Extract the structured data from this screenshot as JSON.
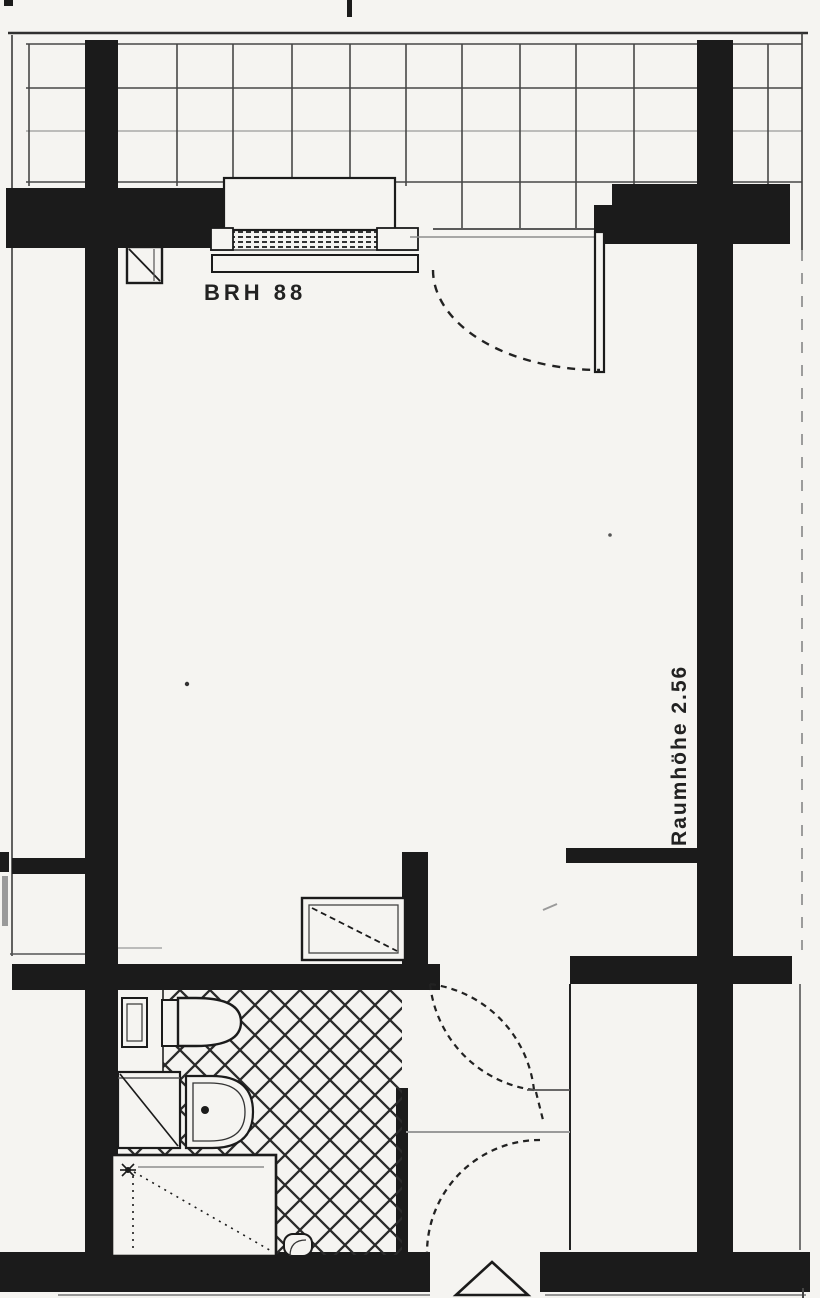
{
  "document": {
    "kind": "scanned apartment floor plan",
    "palette": {
      "paper": "#f5f4f1",
      "ink": "#1b1b1b",
      "faint_gray": "#8d8d8d"
    }
  },
  "annotations": {
    "parapet_height_label": "BRH 88",
    "room_height_label": "Raumhöhe 2.56"
  },
  "symbols": [
    "balcony-tile-grid",
    "window",
    "balcony-door-swing",
    "room-door-swing",
    "entrance-door-swing",
    "shaft-box",
    "cistern",
    "toilet",
    "shower-square",
    "washbasin",
    "bathtub",
    "floor-drain",
    "entrance-triangle-marker",
    "crosshatch-tile-floor"
  ]
}
